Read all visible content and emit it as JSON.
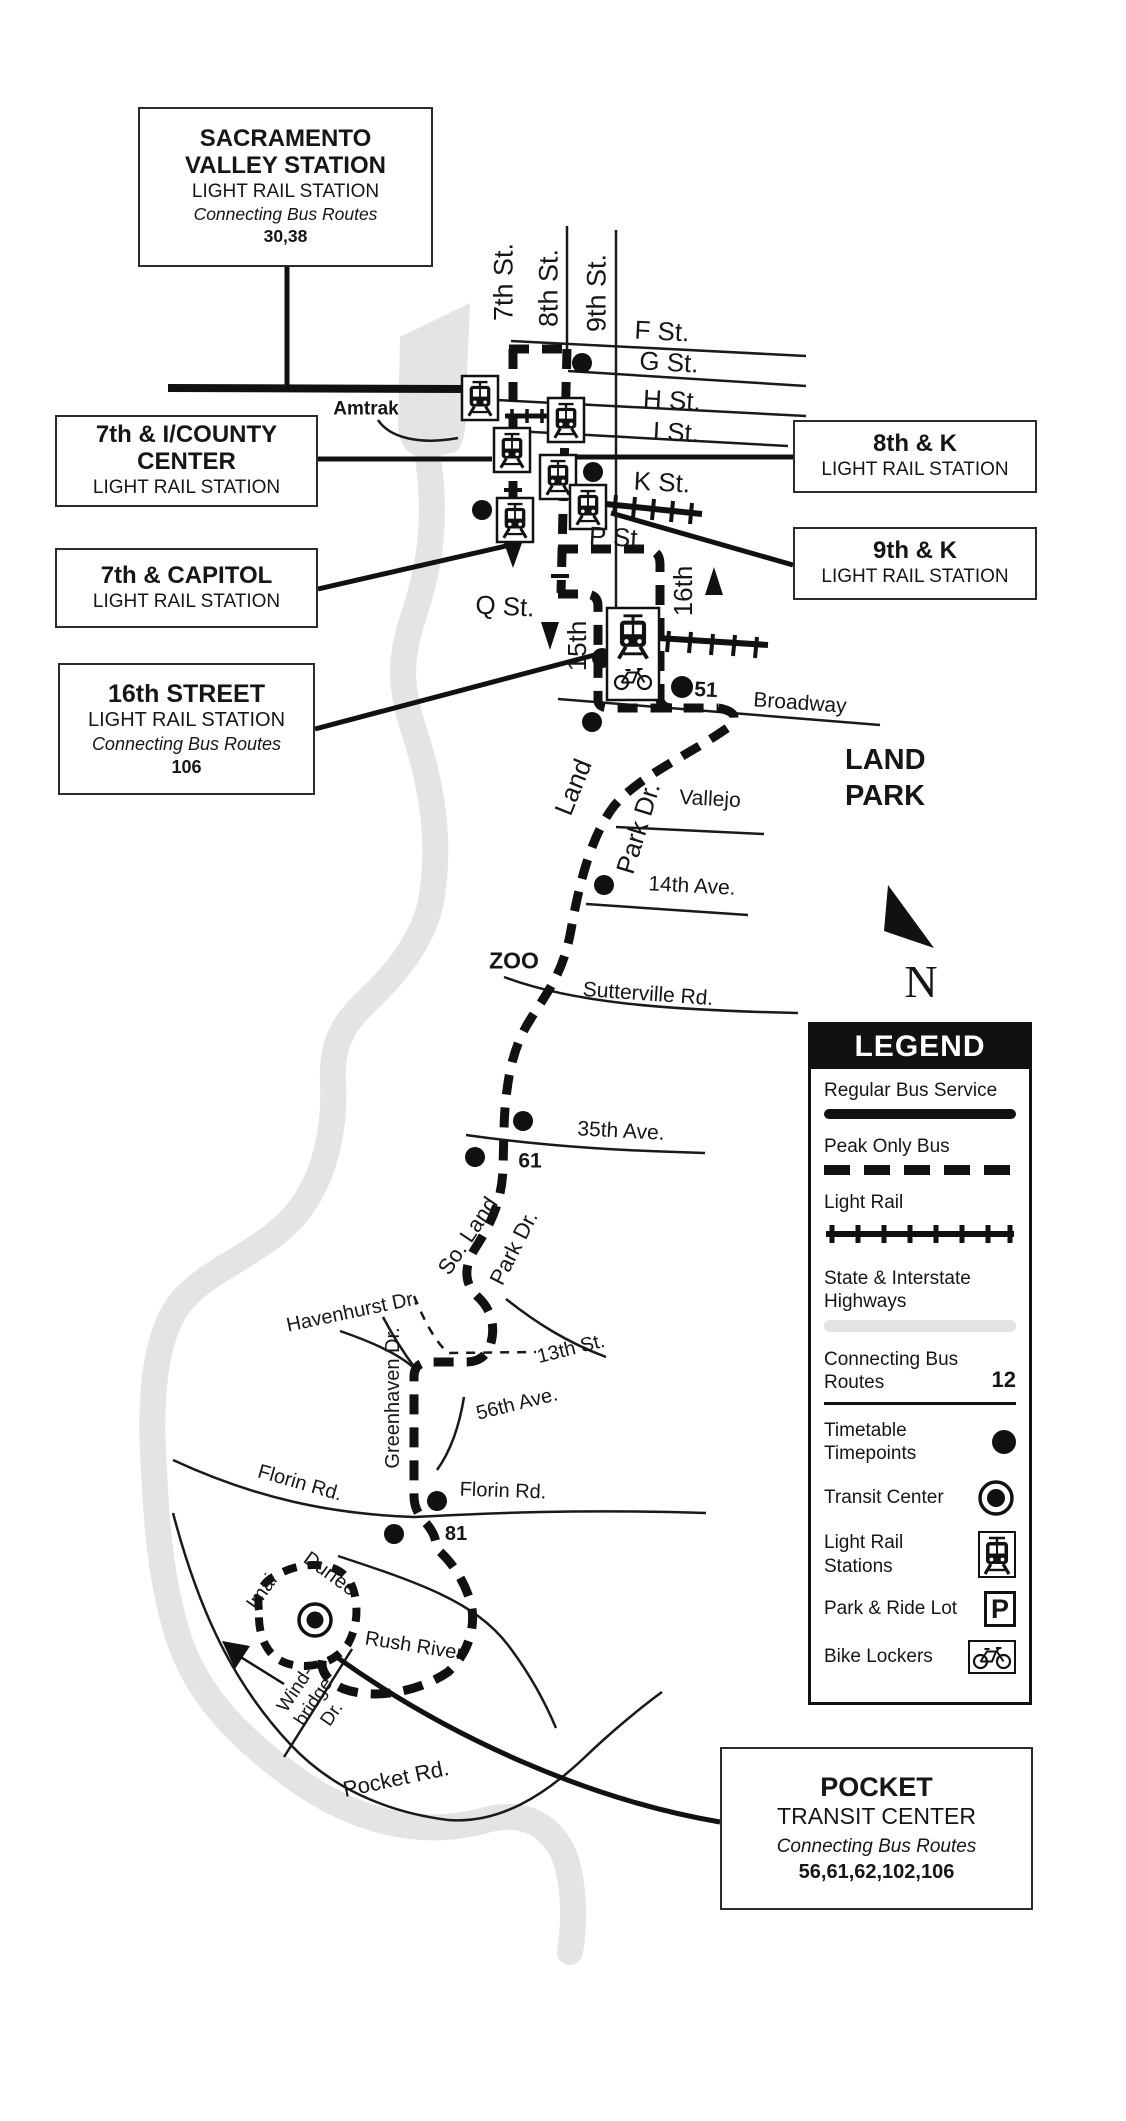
{
  "boxes": {
    "sacramento_valley": {
      "title_line1": "SACRAMENTO",
      "title_line2": "VALLEY STATION",
      "subtitle": "LIGHT RAIL STATION",
      "connecting_label": "Connecting Bus Routes",
      "routes": "30,38"
    },
    "seventh_i_county": {
      "title_line1": "7th & I/COUNTY",
      "title_line2": "CENTER",
      "subtitle": "LIGHT RAIL STATION"
    },
    "seventh_capitol": {
      "title": "7th & CAPITOL",
      "subtitle": "LIGHT RAIL STATION"
    },
    "eighth_k": {
      "title": "8th & K",
      "subtitle": "LIGHT RAIL STATION"
    },
    "ninth_k": {
      "title": "9th & K",
      "subtitle": "LIGHT RAIL STATION"
    },
    "sixteenth_street": {
      "title": "16th STREET",
      "subtitle": "LIGHT RAIL STATION",
      "connecting_label": "Connecting Bus Routes",
      "routes": "106"
    },
    "pocket": {
      "title": "POCKET",
      "subtitle": "TRANSIT CENTER",
      "connecting_label": "Connecting Bus Routes",
      "routes": "56,61,62,102,106"
    }
  },
  "streets": {
    "seventh": "7th St.",
    "eighth": "8th St.",
    "ninth": "9th St.",
    "f": "F St.",
    "g": "G St.",
    "h": "H St.",
    "i": "I St.",
    "k": "K St.",
    "p": "P St.",
    "q": "Q St.",
    "fifteenth": "15th",
    "sixteenth": "16th",
    "broadway": "Broadway",
    "vallejo": "Vallejo",
    "fourteenth_ave": "14th Ave.",
    "sutterville": "Sutterville Rd.",
    "thirty_fifth_ave": "35th Ave.",
    "land": "Land",
    "park_dr": "Park Dr.",
    "so_land": "So. Land",
    "park_dr_2": "Park Dr.",
    "havenhurst": "Havenhurst Dr.",
    "greenhaven": "Greenhaven Dr.",
    "thirteenth": "13th St.",
    "fifty_sixth_ave": "56th Ave.",
    "florin_left": "Florin Rd.",
    "florin_right": "Florin Rd.",
    "durfee": "Durfee",
    "imai": "Imai",
    "rush_river": "Rush River",
    "windbridge_l1": "Wind-",
    "windbridge_l2": "bridge",
    "windbridge_l3": "Dr.",
    "pocket_rd": "Pocket Rd."
  },
  "route_numbers": {
    "broadway": "51",
    "thirty_fifth": "61",
    "florin": "81"
  },
  "places": {
    "amtrak": "Amtrak",
    "zoo": "ZOO",
    "land_park_line1": "LAND",
    "land_park_line2": "PARK"
  },
  "compass": {
    "north": "N"
  },
  "legend": {
    "title": "LEGEND",
    "regular": "Regular Bus Service",
    "peak": "Peak Only Bus",
    "light_rail": "Light Rail",
    "highways_l1": "State & Interstate",
    "highways_l2": "Highways",
    "connecting_l1": "Connecting Bus",
    "connecting_l2": "Routes",
    "connecting_value": "12",
    "timepoints_l1": "Timetable",
    "timepoints_l2": "Timepoints",
    "transit_center": "Transit Center",
    "stations_l1": "Light Rail",
    "stations_l2": "Stations",
    "park_ride": "Park & Ride Lot",
    "park_glyph": "P",
    "bike": "Bike Lockers"
  },
  "colors": {
    "ink": "#161616",
    "river": "#e4e4e4"
  }
}
